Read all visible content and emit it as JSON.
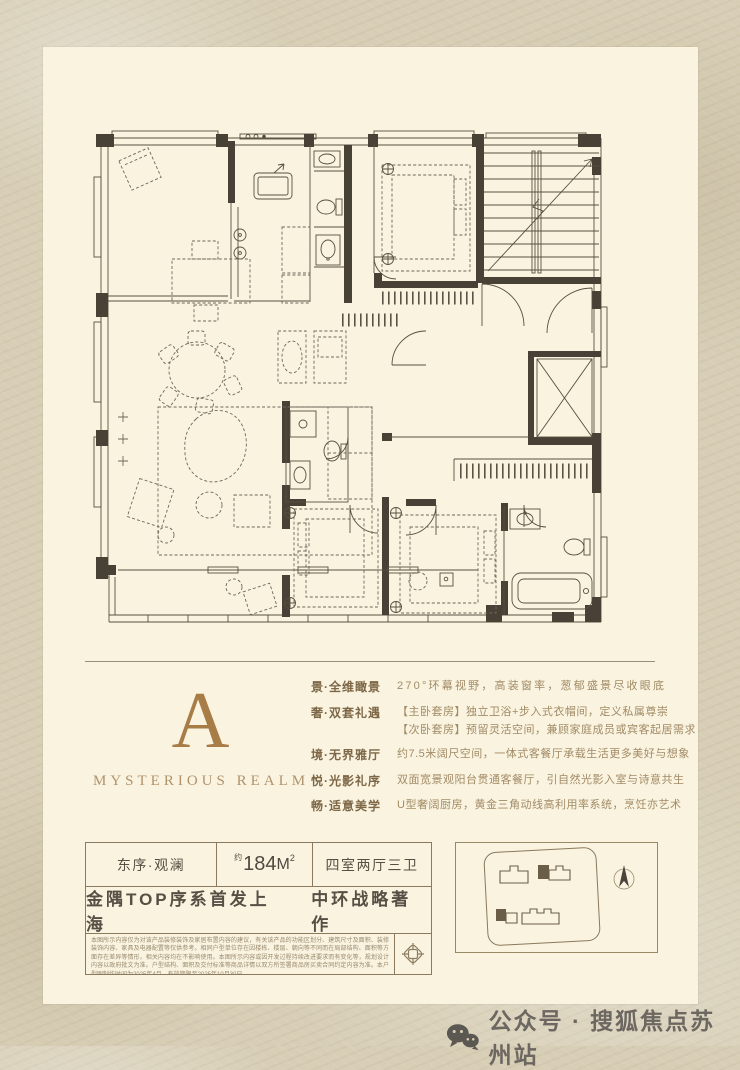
{
  "theme": {
    "bg": "#d7ceb5",
    "panel": "#f9f3e0",
    "accent": "#a87c46",
    "line": "#8b7a5e",
    "ink": "#4e4a42",
    "text": "#a28b66"
  },
  "logo": {
    "letter": "A",
    "subtitle": "MYSTERIOUS REALM"
  },
  "features": [
    {
      "label": "景·全维瞰景",
      "lines": [
        "270°环幕视野，高装窗率，葱郁盛景尽收眼底"
      ]
    },
    {
      "label": "奢·双套礼遇",
      "lines": [
        "【主卧套房】独立卫浴+步入式衣帽间，定义私属尊崇",
        "【次卧套房】预留灵活空间，兼顾家庭成员或宾客起居需求"
      ]
    },
    {
      "label": "境·无界雅厅",
      "lines": [
        "约7.5米阔尺空间，一体式客餐厅承载生活更多美好与想象"
      ]
    },
    {
      "label": "悦·光影礼序",
      "lines": [
        "双面宽景观阳台贯通客餐厅，引自然光影入室与诗意共生"
      ]
    },
    {
      "label": "畅·适意美学",
      "lines": [
        "U型奢阔厨房，黄金三角动线高利用率系统，烹饪亦艺术"
      ]
    }
  ],
  "unit": {
    "name": "东序·观澜",
    "area_approx": "约",
    "area_value": "184",
    "area_unit": "M",
    "area_exp": "2",
    "layout": "四室两厅三卫",
    "tagline_left": "金隅TOP序系首发上海",
    "tagline_right": "中环战略著作"
  },
  "disclaimer": "本图所示内容仅为对该产品装修装饰及家居布置内容的建议，有关该产品的功能区划分、建筑尺寸及面积、装修装饰内容、家具及电器配置等仅供参考。相同户型单位存在因楼栋、楼层、朝向等不同而在局部结构、面积等方面存在差异等情形，相关内容均在不影响使用。本图所示内容或因开发过程持续改进要求而有变化等，规划设计内容以政府批文为准。户型结构、面积及交付标准等商品详情以双方所签署商品房买卖合同约定内容为准。本户型图制作时间为2025年4月，有效期限至2025年10月30日。",
  "footer": {
    "label": "公众号 · 搜狐焦点苏州站"
  },
  "icons": {
    "wechat": "wechat-icon",
    "compass": "north-compass-icon",
    "emblem": "knot-emblem-icon"
  }
}
